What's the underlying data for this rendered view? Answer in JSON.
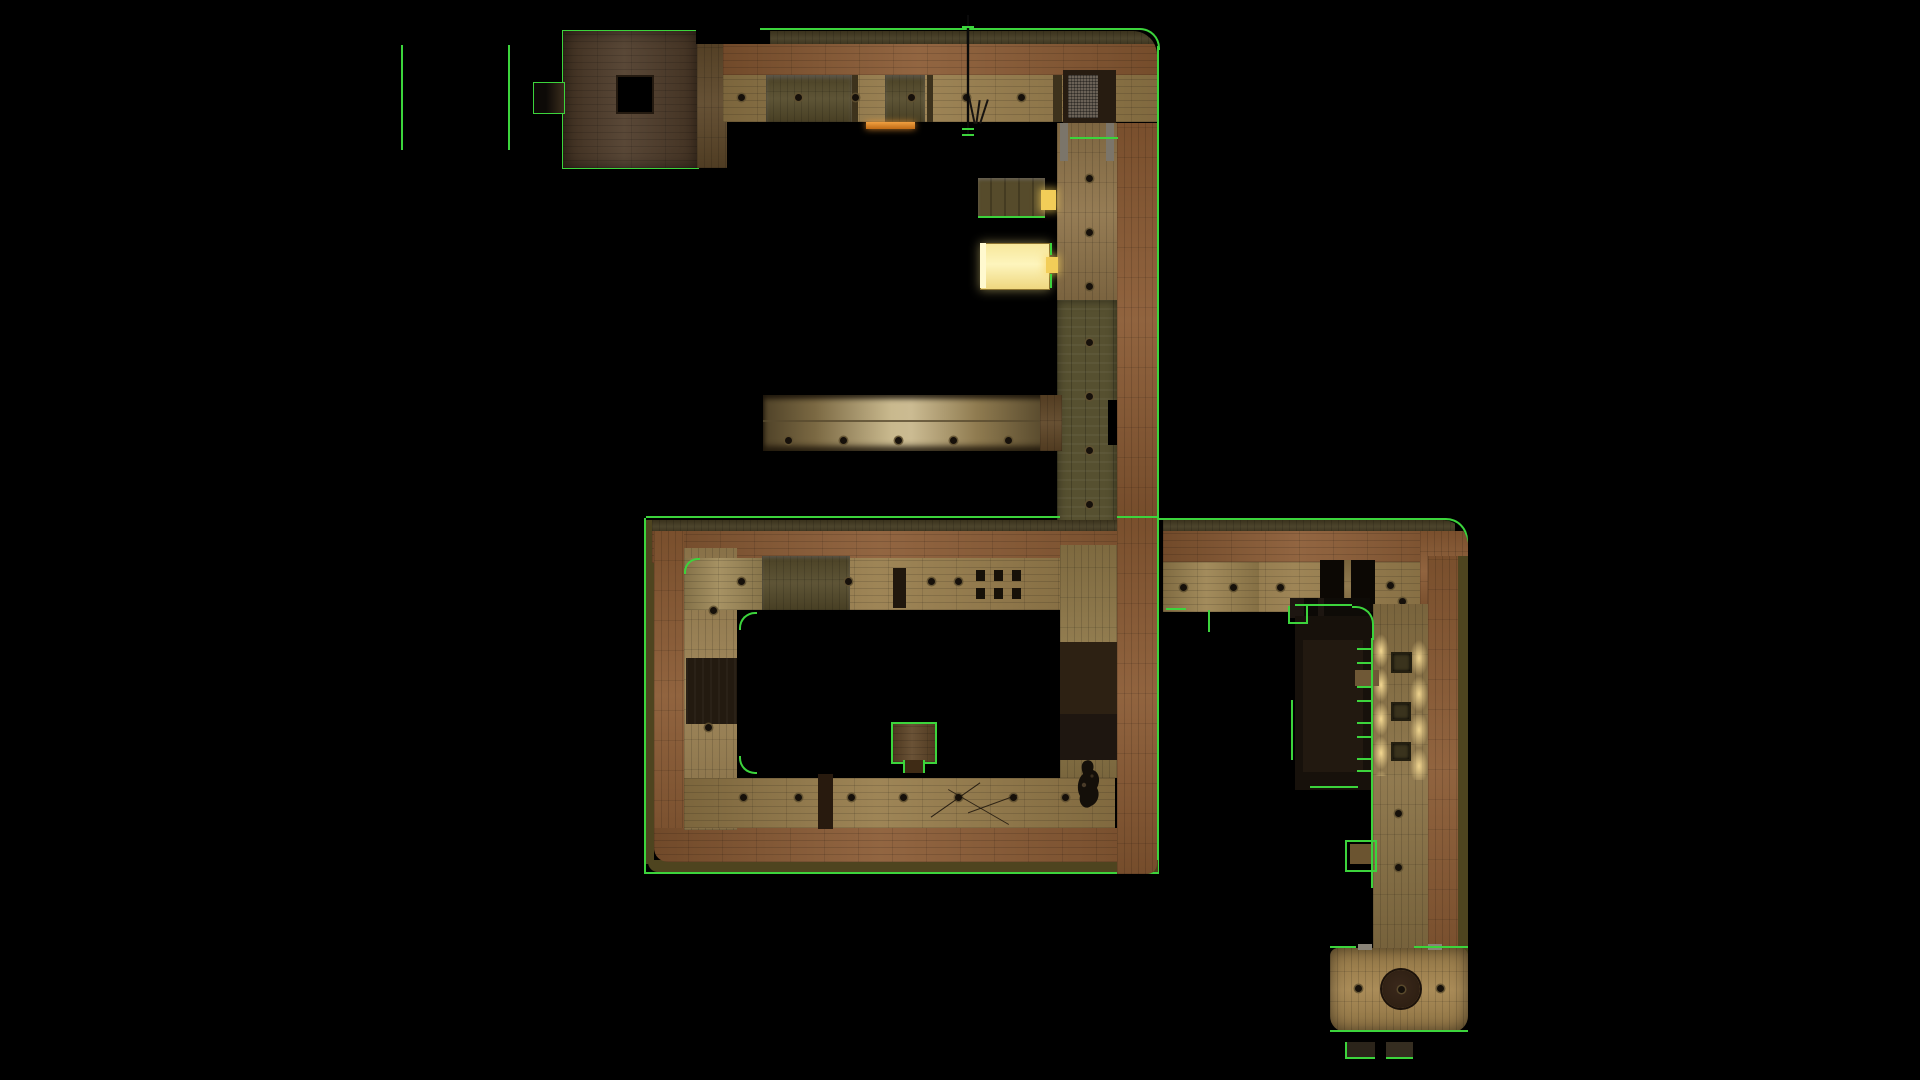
{
  "scene": {
    "type": "game-level-top-down-overview",
    "description": "Top-down orthographic overview of a wooden multi-room game level rendered on a black void, with bright green brush/outline markings typical of a level-editor or spectator map view. No text is visible anywhere in the frame.",
    "background": "#000000"
  },
  "palette": {
    "bg": "#000000",
    "g": "#3cd43c",
    "wood-border": "#8a5a33",
    "wood-border-dark": "#6e4726",
    "wood-floor": "#977c4a",
    "wood-floor-light": "#a08a58",
    "wood-room": "#4d3a28",
    "wood-connector": "#5d4729",
    "grime": "#544a2a",
    "moss": "#565030",
    "olive": "#4e441f",
    "topband": "#423920",
    "darkpanel": "#271c11",
    "yellow": "#f3e295",
    "yellow-bright": "#fdf5bd",
    "ydoor": "#f2cd58",
    "orange-strip": "#d57c1e",
    "brass-light": "#c9b98e",
    "brass-dark": "#55472b",
    "glow": "#f6d98e",
    "room-br": "#a5854e",
    "circle-dark": "#2f2013",
    "faint": "#17110b",
    "figure": "#140f09",
    "graycap": "#7b756a",
    "vent": "#6a6156"
  },
  "features": [
    {
      "name": "stray-outline-lines",
      "label": "Two lone vertical green outline lines floating on the void, upper left"
    },
    {
      "name": "top-left-room",
      "label": "Small dark-wood room with a square black floor hatch and a green-outlined side nook"
    },
    {
      "name": "top-corridor",
      "label": "Long horizontal corridor with orange plank wall band, grimy locker panels, screw dots, a hanging rope and a rounded top-right corner"
    },
    {
      "name": "orange-lit-doorway",
      "label": "Small glowing orange doorway strip on the corridor's lower edge"
    },
    {
      "name": "upper-vertical-corridor",
      "label": "Vertical corridor descending on the right with mossy grimy floor strip and screw dots"
    },
    {
      "name": "locker-room",
      "label": "Small dark panelled room connected by a tiny glowing yellow door"
    },
    {
      "name": "bright-yellow-room",
      "label": "Brightly lit yellow room connected by a tiny glowing yellow door"
    },
    {
      "name": "brass-bridge",
      "label": "Long shiny brass/metal walkway crossing the void into the vertical corridor"
    },
    {
      "name": "ring-courtyard-building",
      "label": "Large rectangular ring-shaped building with wooden border, inner floor ring and black central courtyard"
    },
    {
      "name": "courtyard-pedestal",
      "label": "Small green-outlined wooden pedestal at the courtyard's lower edge"
    },
    {
      "name": "player-figure",
      "label": "Small dark top-down character sprite standing on the ring's right-hand floor"
    },
    {
      "name": "east-corridor",
      "label": "Horizontal corridor leaving the ring to the right with two black doorways and rounded end"
    },
    {
      "name": "lower-vertical-corridor",
      "label": "Vertical corridor descending on the far right with glowing window-light pools and three floor grates"
    },
    {
      "name": "dark-side-room",
      "label": "Nearly black faintly-visible side room left of the lower corridor with green outline ticks"
    },
    {
      "name": "bottom-right-room",
      "label": "Rounded wooden room at the bottom with a large dark circular floor feature"
    },
    {
      "name": "loose-crates",
      "label": "Two small green-outlined dark crates below the bottom-right room"
    }
  ]
}
